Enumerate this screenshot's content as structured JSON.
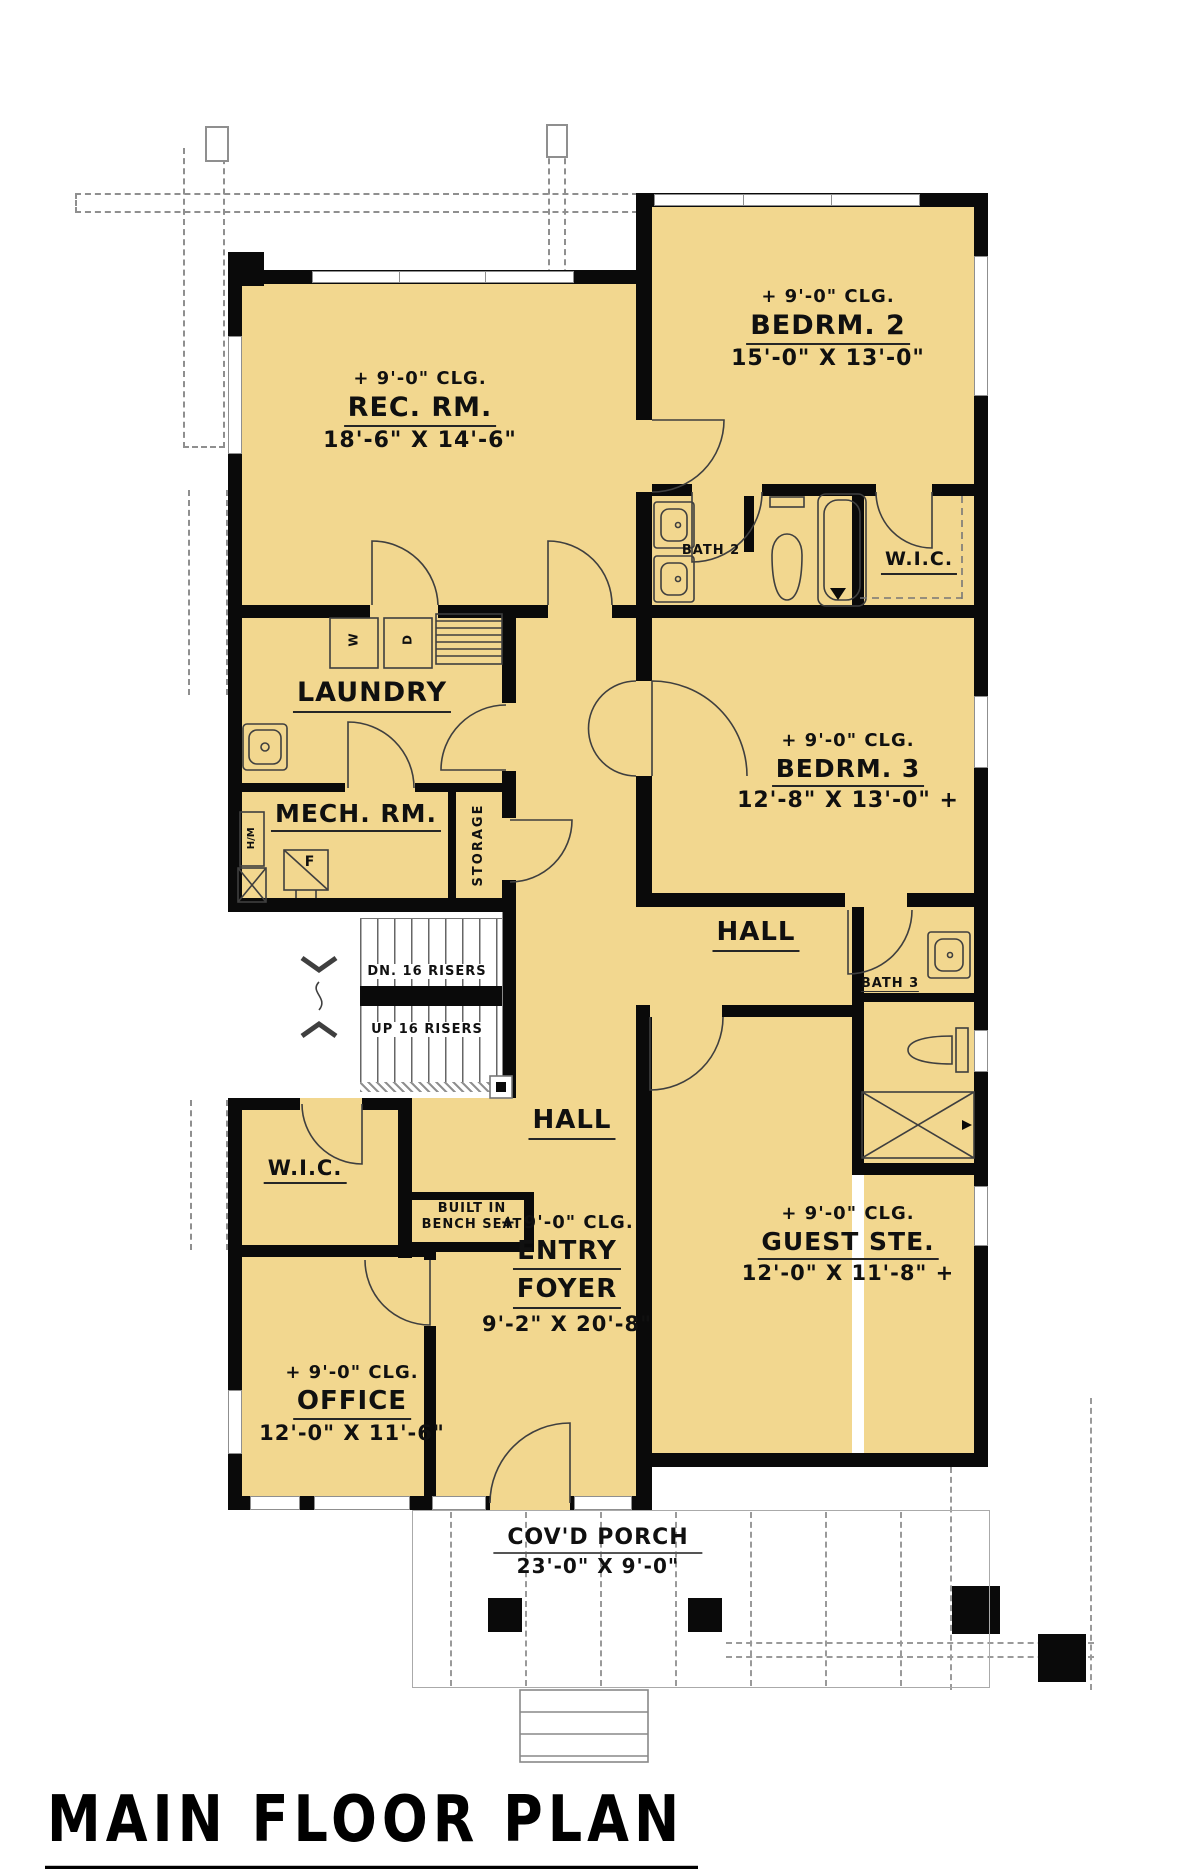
{
  "title": "MAIN FLOOR PLAN",
  "labels": {
    "rec": {
      "clg": "+ 9'-0\" CLG.",
      "name": "REC. RM.",
      "dims": "18'-6\" X 14'-6\""
    },
    "bedrm2": {
      "clg": "+ 9'-0\" CLG.",
      "name": "BEDRM. 2",
      "dims": "15'-0\" X 13'-0\""
    },
    "bath2": {
      "name": "BATH 2"
    },
    "wic2": {
      "name": "W.I.C."
    },
    "laundry": {
      "name": "LAUNDRY",
      "washer": "W",
      "dryer": "D"
    },
    "mech": {
      "name": "MECH. RM.",
      "furnace": "F",
      "hm": "H/M"
    },
    "storage": {
      "name": "STORAGE"
    },
    "bedrm3": {
      "clg": "+ 9'-0\" CLG.",
      "name": "BEDRM. 3",
      "dims": "12'-8\" X 13'-0\" +"
    },
    "hall_upper": {
      "name": "HALL"
    },
    "bath3": {
      "name": "BATH 3"
    },
    "stairs": {
      "dn": "DN. 16 RISERS",
      "up": "UP 16 RISERS"
    },
    "wic_left": {
      "name": "W.I.C."
    },
    "bench": {
      "line1": "BUILT IN",
      "line2": "BENCH SEAT"
    },
    "hall_center": {
      "name": "HALL"
    },
    "entry": {
      "clg": "+ 9'-0\" CLG.",
      "name1": "ENTRY",
      "name2": "FOYER",
      "dims": "9'-2\" X 20'-8\""
    },
    "guest": {
      "clg": "+ 9'-0\" CLG.",
      "name": "GUEST STE.",
      "dims": "12'-0\" X 11'-8\" +"
    },
    "office": {
      "clg": "+ 9'-0\" CLG.",
      "name": "OFFICE",
      "dims": "12'-0\" X 11'-6\""
    },
    "porch": {
      "name": "COV'D PORCH",
      "dims": "23'-0\" X 9'-0\""
    }
  },
  "colors": {
    "floor": "#F2D78F",
    "wall": "#0a0a0a",
    "line": "#3f3f3f",
    "dashed": "#8f8f8f"
  }
}
